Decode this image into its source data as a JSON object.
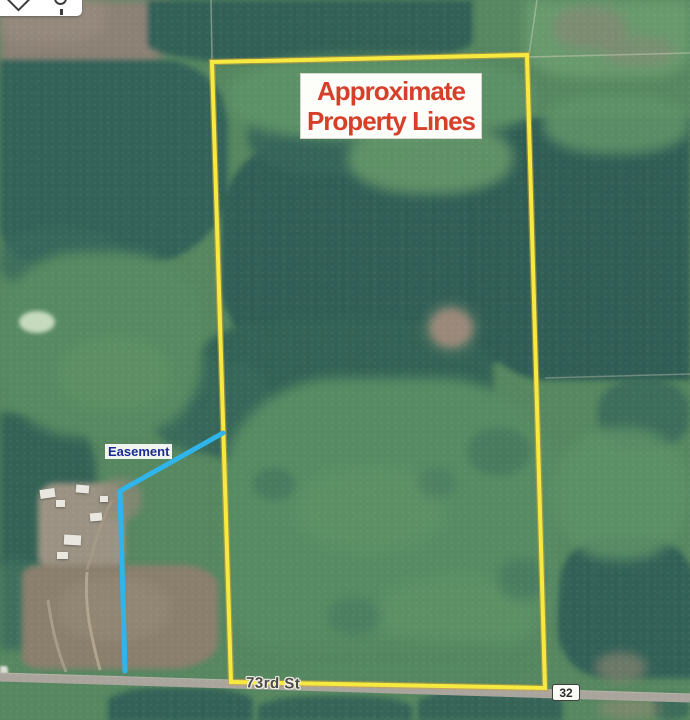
{
  "map_annotations": {
    "title_line1": "Approximate",
    "title_line2": "Property Lines",
    "easement_label": "Easement",
    "road_label": "73rd St",
    "route_badge": "32"
  },
  "colors": {
    "property_boundary": "#f6e93f",
    "property_boundary_halo": "#cfa23a",
    "easement_line": "#2fb5ec",
    "title_text": "#d6402b",
    "easement_text": "#1b2a96",
    "road_fill": "#a9a59d"
  },
  "toolbar": {
    "icons": [
      "diamond-tool-icon",
      "pin-tool-icon"
    ]
  }
}
